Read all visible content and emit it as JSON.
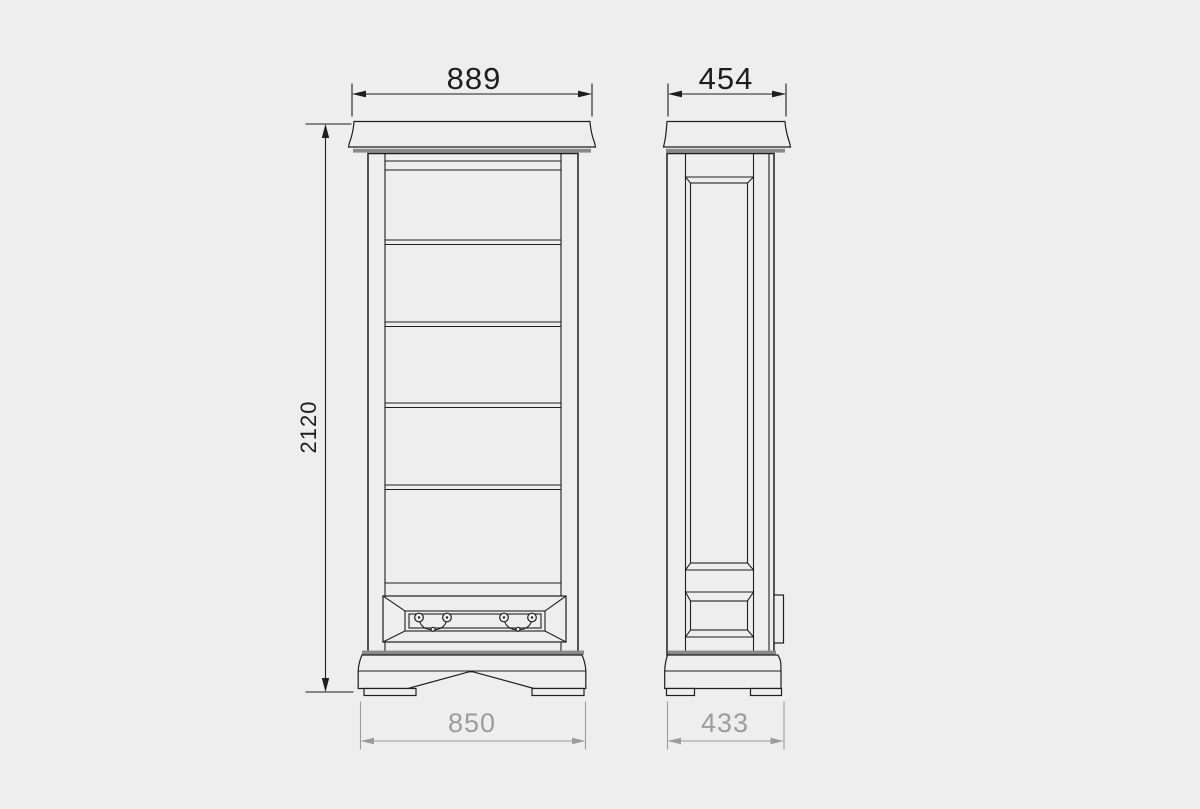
{
  "colors": {
    "background": "#eeeeee",
    "line": "#1f1f1f",
    "band_gray": "#8a8a8a",
    "dim_primary": "#1e1e1e",
    "dim_secondary": "#9c9c9c"
  },
  "drawing": {
    "type": "furniture-dimension-diagram",
    "front_view": {
      "width_top_label": "889",
      "height_label": "2120",
      "width_base_label": "850"
    },
    "side_view": {
      "depth_top_label": "454",
      "depth_base_label": "433"
    }
  }
}
